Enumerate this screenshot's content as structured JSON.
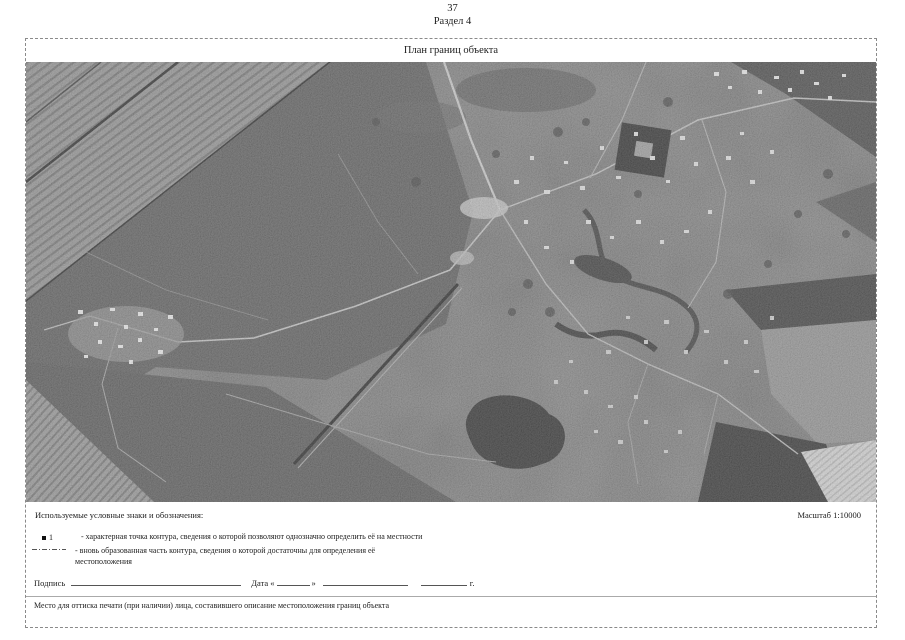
{
  "page": {
    "number": "37",
    "section_title": "Раздел 4"
  },
  "plan": {
    "title": "План границ объекта",
    "scale_label": "Масштаб 1:10000"
  },
  "legend": {
    "heading": "Используемые условные знаки и обозначения:",
    "items": [
      {
        "symbol": "filled-point",
        "label": "1",
        "text": "- характерная точка контура, сведения о которой позволяют однозначно определить её на местности"
      },
      {
        "symbol": "dash-dot-line",
        "text": "- вновь образованная часть контура, сведения о которой достаточны для определения её местоположения"
      }
    ]
  },
  "signature_row": {
    "signature_label": "Подпись",
    "date_label": "Дата",
    "open_quote": "«",
    "close_quote": "»",
    "year_suffix": "г."
  },
  "stamp_note": "Место для оттиска печати (при наличии) лица, составившего описание местоположения границ объекта"
}
